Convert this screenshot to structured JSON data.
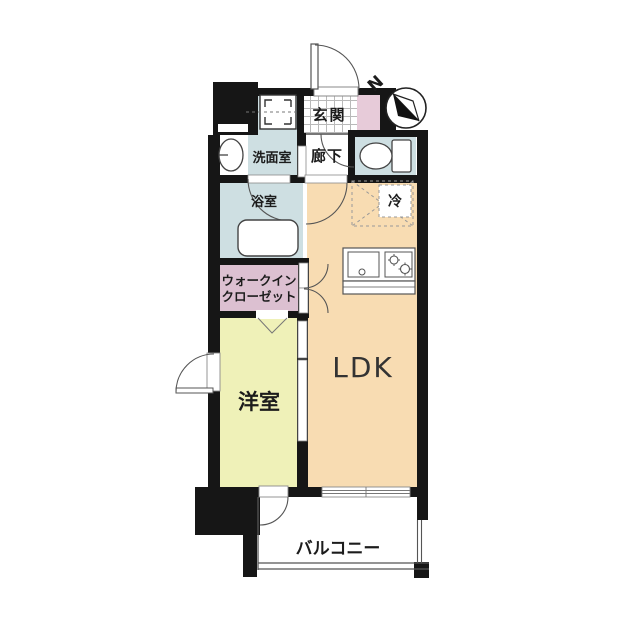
{
  "title": "apartment-floor-plan",
  "compass": {
    "label": "N"
  },
  "rooms": {
    "genkan": {
      "label": "玄関"
    },
    "hallway": {
      "label": "廊下"
    },
    "washroom": {
      "label": "洗面室"
    },
    "bathroom": {
      "label": "浴室"
    },
    "toilet": {
      "label": ""
    },
    "wic": {
      "line1": "ウォークイン",
      "line2": "クローゼット"
    },
    "ldk": {
      "label": "LDK"
    },
    "bedroom": {
      "label": "洋室"
    },
    "balcony": {
      "label": "バルコニー"
    },
    "fridge": {
      "label": "冷"
    }
  },
  "colors": {
    "wall": "#161616",
    "wet_area_blue": "#cedfe2",
    "genkan_pink": "#e7cbd9",
    "wic_pink": "#dcc0d1",
    "ldk_beige": "#f8dcb2",
    "bedroom_yellow": "#eff1b8",
    "line_gray": "#555555"
  }
}
